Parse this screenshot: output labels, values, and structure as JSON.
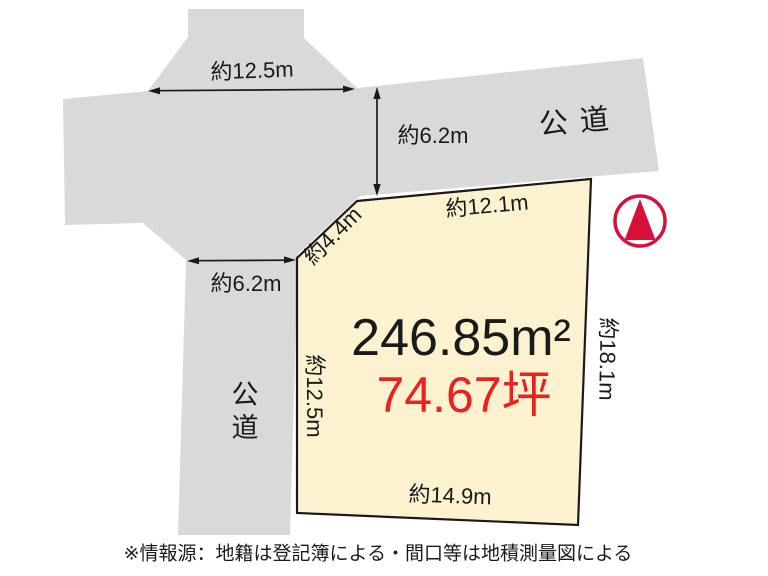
{
  "diagram": {
    "roads": {
      "top_label": "公 道",
      "left_label": "公道",
      "top_frontage": "約12.5m",
      "top_width": "約6.2m",
      "left_width": "約6.2m"
    },
    "parcel": {
      "area_m2": "246.85m²",
      "area_tsubo": "74.67坪",
      "edge_top": "約12.1m",
      "edge_cut": "約4.4m",
      "edge_left": "約12.5m",
      "edge_right": "約18.1m",
      "edge_bottom": "約14.9m"
    },
    "footer": {
      "note": "※情報源：地籍は登記簿による・間口等は地積測量図による"
    },
    "icons": {
      "north_arrow": "north-arrow-icon"
    },
    "colors": {
      "road_gray": "#d9d9d9",
      "parcel_fill": "#fcf2d0",
      "parcel_border": "#1a1a1a",
      "red_text": "#e8231f",
      "north_red": "#d6123b",
      "line_black": "#1a1a1a"
    }
  }
}
